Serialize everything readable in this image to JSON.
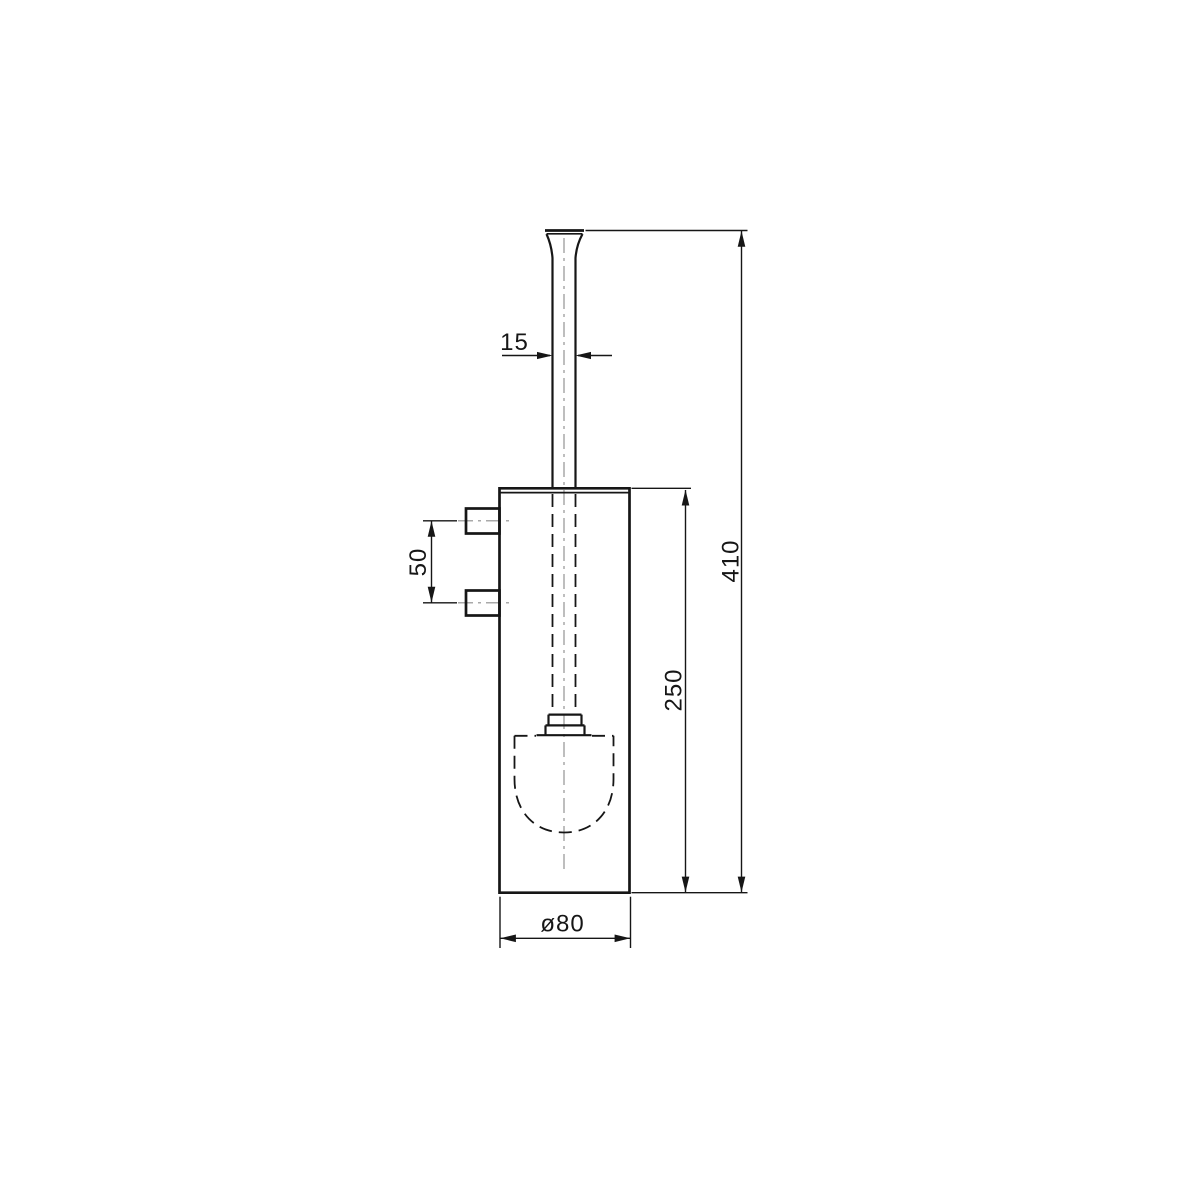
{
  "drawing": {
    "type": "technical-drawing",
    "subject": "Wall-mounted toilet brush holder, front elevation with dimensions",
    "units": "mm",
    "labels": {
      "handle_diameter": "15",
      "mount_spacing": "50",
      "body_height": "250",
      "overall_height": "410",
      "body_diameter": "ø80"
    },
    "colors": {
      "object_line": "#161616",
      "dimension_line": "#161616",
      "centerline": "#a9a9a9",
      "background": "#ffffff"
    }
  }
}
